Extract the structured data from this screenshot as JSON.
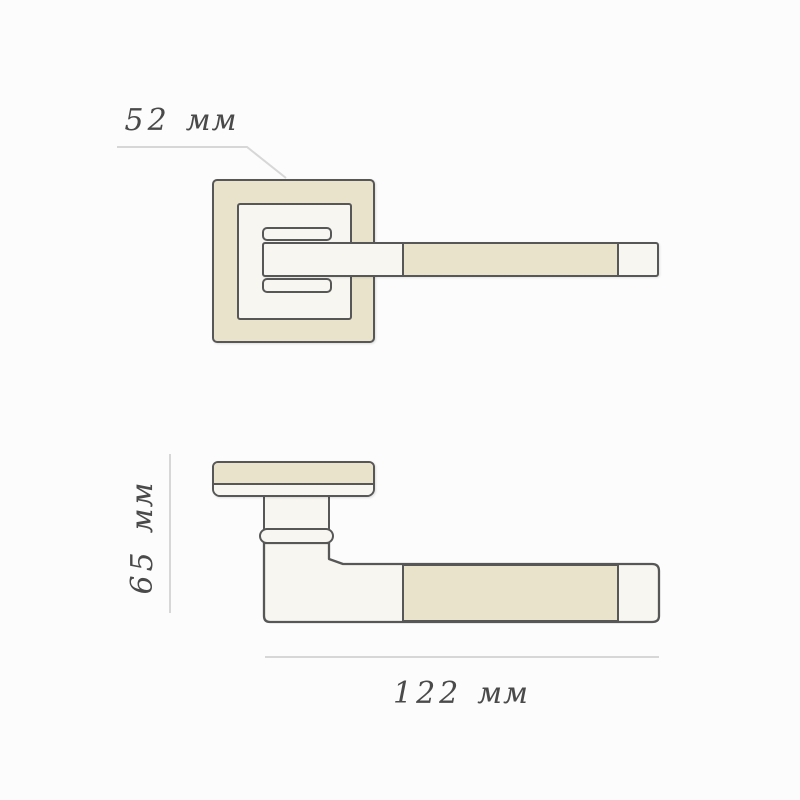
{
  "dimensions": {
    "width": {
      "value": "52",
      "unit": "мм"
    },
    "height": {
      "value": "65",
      "unit": "мм"
    },
    "length": {
      "value": "122",
      "unit": "мм"
    }
  },
  "colors": {
    "bg": "#fcfcfc",
    "fill-light": "#f8f6f0",
    "fill-beige": "#e8e3ca",
    "stroke": "#575757",
    "dim-line": "#d7d7d7",
    "text": "#4a4a4a"
  }
}
